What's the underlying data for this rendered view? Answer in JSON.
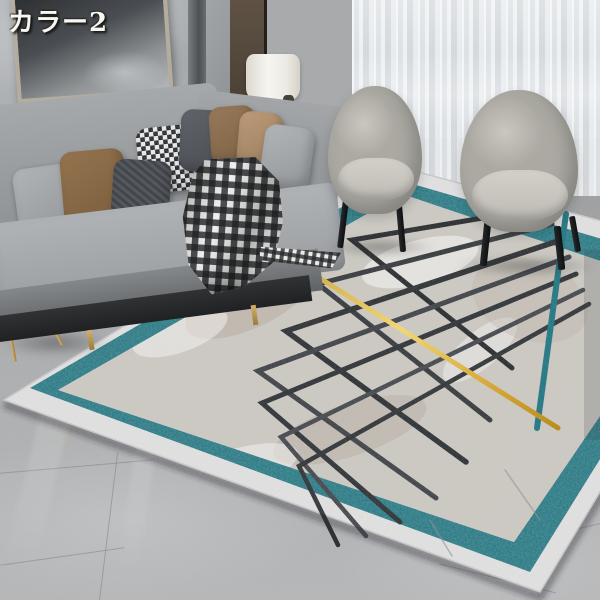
{
  "overlay": {
    "label": "カラー2"
  },
  "colors": {
    "teal": "#1d7582",
    "teal_deep": "#135d68",
    "gold": "#d8a62e",
    "gold_light": "#f2cf6b",
    "rug_field": "#ccc9c3",
    "rug_band": "#e4e4e5",
    "chevron_dark": "#2c3034",
    "chevron_mid": "#4b4f54",
    "wall_marble": "#aeb1b4",
    "wood_panel": "#4a3e32",
    "curtain_dark": "#5c6064",
    "curtain_sheer": "#e4e7ea",
    "sofa_grey": "#9da0a3",
    "sofa_base": "#26282b",
    "chair_grey": "#b9b7af",
    "floor_marble": "#a8aaac",
    "lamp_shade": "#f1efe9",
    "brass": "#c29b4e",
    "pillow_brown": "#8a6c4a",
    "pillow_tan": "#b29070",
    "pillow_charcoal": "#53575b",
    "pillow_light": "#a7abae",
    "art_dark": "#3d4045"
  },
  "scene": {
    "objects": [
      "marble-wall",
      "framed-artwork",
      "wood-panel",
      "dark-curtain",
      "sheer-curtain",
      "grey-sofa",
      "throw-pillows",
      "checkered-throw-blanket",
      "table-lamp",
      "lamp-side-table",
      "corner-side-table",
      "photo-frames",
      "magazines",
      "armchair-left",
      "armchair-right",
      "area-rug-chevron-teal-border",
      "marble-floor"
    ]
  }
}
